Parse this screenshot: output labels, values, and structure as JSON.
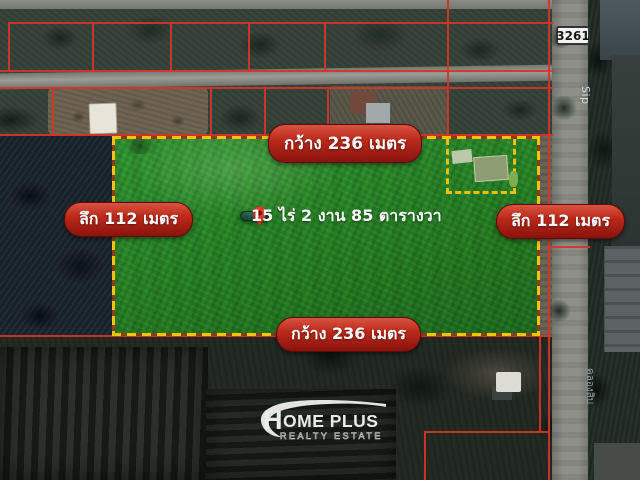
{
  "map": {
    "route_shield": "3261",
    "road_label_latin": "Sip",
    "road_label_thai": "คลองสิบ"
  },
  "annotations": {
    "width_top": "กว้าง 236 เมตร",
    "width_bottom": "กว้าง 236 เมตร",
    "depth_left": "ลึก 112 เมตร",
    "depth_right": "ลึก 112 เมตร",
    "area": "15 ไร่ 2 งาน 85 ตารางวา"
  },
  "logo": {
    "initial": "H",
    "name_rest": "OME PLUS",
    "subtitle": "REALTY ESTATE"
  },
  "colors": {
    "boundary_red": "#d63427",
    "plot_dash_yellow": "#f6c400",
    "plot_green": "#2f9430",
    "label_pill_red": "#a01810",
    "area_pill_green": "#1c5240",
    "pin_red": "#e33a2c",
    "shield_bg": "#f4f4f2"
  }
}
